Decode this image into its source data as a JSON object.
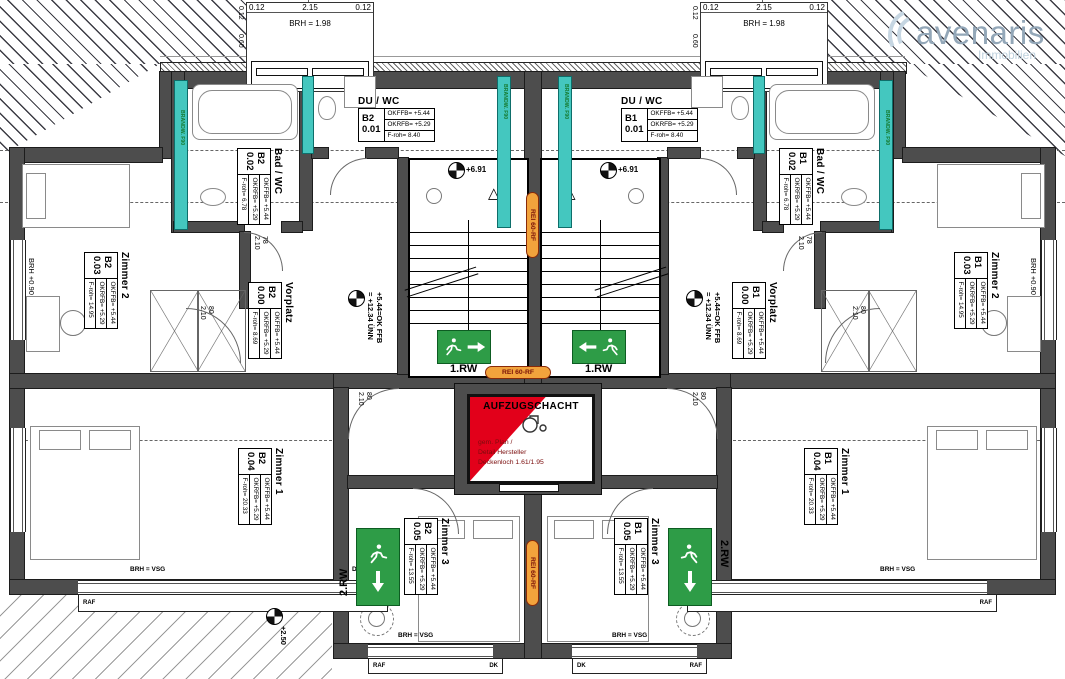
{
  "logo": {
    "name": "avenaris",
    "tagline": "Immobilien"
  },
  "fire": {
    "label": "REI 60-RF"
  },
  "firewall": {
    "label": "BRANDW. F90"
  },
  "escape": {
    "rw1": "1.RW",
    "rw2": "2.RW"
  },
  "elevator": {
    "title": "AUFZUGSCHACHT",
    "note1": "gem. Plan /",
    "note2": "Detail Hersteller",
    "note3": "Deckenloch  1.61/1.95"
  },
  "levels": {
    "stair": "+6.91",
    "main_a": "+5.44=OK FFB",
    "main_b": "= +12.34 ÜNN",
    "corner": "+2.50"
  },
  "stairbox": {
    "r0": "OKFFB= +6.91",
    "r1": "OKRFB= +6.81",
    "r2": "F-roh= 2.22"
  },
  "stairs": {
    "stg": "8 STG",
    "tread": "18,4/27"
  },
  "dormer": {
    "w_left": "0.12",
    "w_mid": "2.15",
    "w_right": "0.12",
    "brh": "BRH = 1.98",
    "v_top": "0.12",
    "v_bot": "0.60"
  },
  "doors": {
    "bath_w": "78",
    "bath_h": "2.10",
    "room_w": "80",
    "room_h": "2.10"
  },
  "windows": {
    "vsg": "BRH = VSG",
    "brh090": "BRH +0.90",
    "dk": "DK",
    "raf": "RAF",
    "wfb": "WFB"
  },
  "rooms": [
    {
      "name": "DU / WC",
      "unit": "B2",
      "num": "0.01",
      "rows": [
        "OKFFB= +5.44",
        "OKRFB= +5.29",
        "F-roh= 8.40"
      ]
    },
    {
      "name": "DU / WC",
      "unit": "B1",
      "num": "0.01",
      "rows": [
        "OKFFB= +5.44",
        "OKRFB= +5.29",
        "F-roh= 8.40"
      ]
    },
    {
      "name": "Bad / WC",
      "unit": "B2",
      "num": "0.02",
      "rows": [
        "OKFFB= +5.44",
        "OKRFB= +5.29",
        "F-roh= 6.78"
      ]
    },
    {
      "name": "Bad / WC",
      "unit": "B1",
      "num": "0.02",
      "rows": [
        "OKFFB= +5.44",
        "OKRFB= +5.29",
        "F-roh= 6.78"
      ]
    },
    {
      "name": "Zimmer 2",
      "unit": "B2",
      "num": "0.03",
      "rows": [
        "OKFFB= +5.44",
        "OKRFB= +5.29",
        "F-roh= 14.95"
      ]
    },
    {
      "name": "Zimmer 2",
      "unit": "B1",
      "num": "0.03",
      "rows": [
        "OKFFB= +5.44",
        "OKRFB= +5.29",
        "F-roh= 14.95"
      ]
    },
    {
      "name": "Vorplatz",
      "unit": "B2",
      "num": "0.00",
      "rows": [
        "OKFFB= +5.44",
        "OKRFB= +5.29",
        "F-roh= 8.69"
      ]
    },
    {
      "name": "Vorplatz",
      "unit": "B1",
      "num": "0.00",
      "rows": [
        "OKFFB= +5.44",
        "OKRFB= +5.29",
        "F-roh= 8.69"
      ]
    },
    {
      "name": "Zimmer 1",
      "unit": "B2",
      "num": "0.04",
      "rows": [
        "OKFFB= +5.44",
        "OKRFB= +5.29",
        "F-roh= 20.33"
      ]
    },
    {
      "name": "Zimmer 1",
      "unit": "B1",
      "num": "0.04",
      "rows": [
        "OKFFB= +5.44",
        "OKRFB= +5.29",
        "F-roh= 20.33"
      ]
    },
    {
      "name": "Zimmer 3",
      "unit": "B2",
      "num": "0.05",
      "rows": [
        "OKFFB= +5.44",
        "OKRFB= +5.29",
        "F-roh= 13.55"
      ]
    },
    {
      "name": "Zimmer 3",
      "unit": "B1",
      "num": "0.05",
      "rows": [
        "OKFFB= +5.44",
        "OKRFB= +5.29",
        "F-roh= 13.55"
      ]
    }
  ]
}
